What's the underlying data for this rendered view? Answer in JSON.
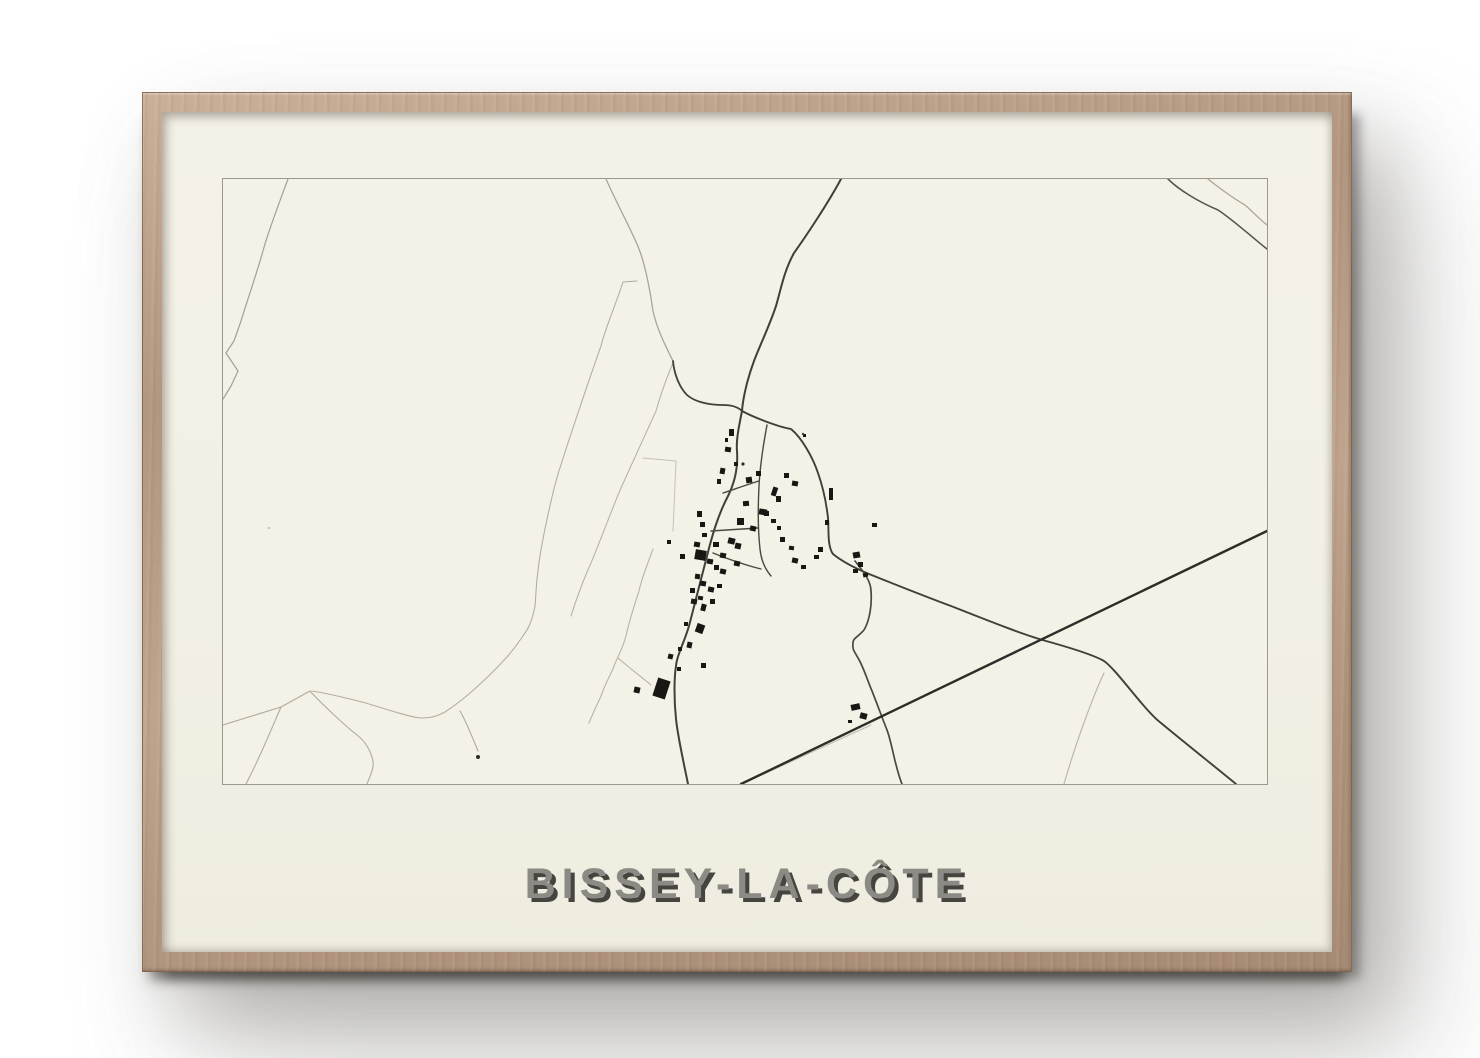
{
  "poster": {
    "title": "BISSEY-LA-CÔTE"
  },
  "palette": {
    "page_background": "#ffffff",
    "frame_wood": "#b89c84",
    "frame_wood_highlight": "#cab097",
    "frame_wood_dark": "#a68a72",
    "mat_cream": "#f2efe4",
    "map_background": "#f4f1e6",
    "map_border": "#9b988c",
    "road_dark": "#413f39",
    "road_darkest": "#2e2d29",
    "road_light": "#b7b4a7",
    "building": "#181713",
    "title_color": "#8b8a84",
    "title_shadow": "#45443f"
  },
  "map": {
    "width": 1044,
    "height": 605,
    "roads": [
      {
        "name": "field-line-top-left",
        "d": "M65 0 C56 24 44 56 40 72 C32 100 22 128 18 142 L11 162 L3 174 L15 192 L8 207 L0 220",
        "color": "#a3a196",
        "width": 1.2
      },
      {
        "name": "field-curve-north",
        "d": "M383 0 C394 25 409 52 416 70 C423 88 428 117 430 132 C434 150 442 166 450 182",
        "color": "#a8a59a",
        "width": 1.3
      },
      {
        "name": "field-band-west-a",
        "d": "M414 102 L400 103 C393 125 382 150 378 167 C369 192 344 266 336 292 C329 314 317 370 315 392 C313 405 313 417 312 427 C310 438 307 447 302 454 C295 464 290 472 282 480 C273 490 248 516 222 533 C215 537 207 539 200 539 C191 540 157 528 149 526 C141 523 103 514 89 512",
        "color": "#b2afa2",
        "width": 1.1
      },
      {
        "name": "field-band-west-b",
        "d": "M450 184 C443 200 437 218 433 232 C424 252 406 291 398 309 C389 330 374 370 368 384 C361 399 352 424 348 437",
        "color": "#b7b4a7",
        "width": 1.1
      },
      {
        "name": "field-line-south-village",
        "d": "M430 370 C425 384 419 398 416 412 C411 427 406 443 403 457 C399 472 393 480 390 490 C385 500 381 508 378 517 C374 526 369 536 366 544",
        "color": "#b7b4a7",
        "width": 1.1
      },
      {
        "name": "field-line-south-village-branch",
        "d": "M395 479 C403 486 412 493 428 506",
        "color": "#b7b4a7",
        "width": 1.1
      },
      {
        "name": "parcel-outline-west",
        "d": "M420 279 L453 282 L450 352",
        "color": "#c4c1b4",
        "width": 1.0
      },
      {
        "name": "field-network-a",
        "d": "M87 512 L58 528 L0 546",
        "color": "#aeab9e",
        "width": 1.1
      },
      {
        "name": "field-network-b",
        "d": "M58 528 C50 546 40 572 23 605",
        "color": "#aeab9e",
        "width": 1.1
      },
      {
        "name": "field-network-c",
        "d": "M87 512 C96 522 121 546 134 556 C142 562 148 572 150 582 C151 590 147 597 144 605",
        "color": "#aeab9e",
        "width": 1.1
      },
      {
        "name": "farm-spur",
        "d": "M237 532 C243 542 250 560 255 572",
        "color": "#aeab9e",
        "width": 1.1
      },
      {
        "name": "old-track-parallel",
        "d": "M519 605 L648 546",
        "color": "#c0bdb0",
        "width": 1.1
      },
      {
        "name": "branch-southeast",
        "d": "M881 494 C871 515 853 563 841 605",
        "color": "#b7b4a7",
        "width": 1.1
      },
      {
        "name": "road-topright-light",
        "d": "M985 0 C996 9 1013 21 1022 26 C1028 31 1034 38 1044 46",
        "color": "#a9a699",
        "width": 1.3
      },
      {
        "name": "road-topright-dark",
        "d": "M945 0 C956 11 976 23 995 31 C1009 40 1030 59 1044 70",
        "color": "#56544d",
        "width": 1.6
      },
      {
        "name": "road-north",
        "d": "M618 0 C604 26 581 60 571 74 C561 92 558 110 553 127 C546 148 537 166 531 182 C525 198 520 218 519 232",
        "color": "#413f39",
        "width": 2
      },
      {
        "name": "road-northwest-link",
        "d": "M450 182 C451 194 456 208 464 216 C473 224 489 226 500 226 C509 226 515 228 519 232",
        "color": "#413f39",
        "width": 1.8
      },
      {
        "name": "main-street",
        "d": "M519 232 C516 247 513 261 514 272 C515 286 513 301 505 317 C495 336 489 357 484 377 C479 396 472 424 466 447 C461 464 454 476 453 487 C451 499 451 521 453 540 C455 559 461 585 465 605",
        "color": "#413f39",
        "width": 2
      },
      {
        "name": "road-east-loop",
        "d": "M519 232 C532 239 556 248 568 250 C579 259 590 279 595 294 C601 311 604 330 605 339 C606 349 604 367 610 375 C621 384 634 390 646 395 C666 403 701 417 728 427 C761 440 801 456 823 462 C841 467 869 475 881 482 C894 491 921 531 938 544 C956 559 996 591 1013 605",
        "color": "#413f39",
        "width": 1.9
      },
      {
        "name": "road-south-curve",
        "d": "M632 382 C640 392 648 402 648 412 C649 425 647 441 641 451 C634 459 630 459 630 464 C629 471 632 473 635 479 C640 487 644 500 649 512 C653 522 660 541 664 551 C669 564 672 588 679 605",
        "color": "#4a4841",
        "width": 1.7
      },
      {
        "name": "straight-diagonal-road",
        "d": "M518 605 L1044 352",
        "color": "#2e2d29",
        "width": 2.4
      },
      {
        "name": "village-lane-vertical",
        "d": "M544 246 C541 262 537 287 536 307 C535 327 535 352 537 370 C538 380 542 390 548 397",
        "color": "#4a4841",
        "width": 1.4
      },
      {
        "name": "village-lane-upper",
        "d": "M500 314 C512 310 526 305 536 302",
        "color": "#4a4841",
        "width": 1.4
      },
      {
        "name": "village-lane-mid",
        "d": "M488 352 L535 349",
        "color": "#4a4841",
        "width": 1.4
      },
      {
        "name": "village-lane-lower",
        "d": "M490 374 C505 380 522 386 538 390",
        "color": "#4a4841",
        "width": 1.4
      }
    ],
    "buildings": [
      [
        506,
        250,
        5,
        7,
        0
      ],
      [
        502,
        268,
        6,
        5,
        8
      ],
      [
        511,
        283,
        4,
        4,
        0
      ],
      [
        497,
        289,
        5,
        6,
        10
      ],
      [
        494,
        300,
        4,
        5,
        0
      ],
      [
        523,
        298,
        6,
        6,
        -8
      ],
      [
        533,
        292,
        5,
        5,
        0
      ],
      [
        549,
        308,
        5,
        9,
        18
      ],
      [
        520,
        322,
        6,
        5,
        -5
      ],
      [
        536,
        330,
        8,
        6,
        10
      ],
      [
        514,
        339,
        7,
        7,
        0
      ],
      [
        527,
        347,
        6,
        5,
        12
      ],
      [
        505,
        359,
        7,
        6,
        14
      ],
      [
        474,
        332,
        5,
        6,
        0
      ],
      [
        477,
        343,
        5,
        5,
        0
      ],
      [
        479,
        354,
        5,
        4,
        0
      ],
      [
        471,
        363,
        6,
        5,
        10
      ],
      [
        490,
        363,
        6,
        5,
        0
      ],
      [
        512,
        364,
        6,
        6,
        12
      ],
      [
        497,
        374,
        6,
        5,
        10
      ],
      [
        511,
        382,
        6,
        5,
        12
      ],
      [
        472,
        371,
        11,
        10,
        10
      ],
      [
        484,
        380,
        6,
        5,
        10
      ],
      [
        491,
        386,
        5,
        5,
        0
      ],
      [
        497,
        390,
        6,
        5,
        12
      ],
      [
        472,
        395,
        5,
        5,
        8
      ],
      [
        477,
        402,
        6,
        5,
        10
      ],
      [
        485,
        408,
        6,
        5,
        12
      ],
      [
        467,
        409,
        5,
        5,
        0
      ],
      [
        475,
        417,
        5,
        4,
        10
      ],
      [
        494,
        405,
        5,
        4,
        0
      ],
      [
        606,
        309,
        4,
        12,
        0
      ],
      [
        595,
        368,
        5,
        5,
        0
      ],
      [
        630,
        373,
        7,
        6,
        -10
      ],
      [
        635,
        383,
        5,
        5,
        0
      ],
      [
        630,
        390,
        5,
        4,
        0
      ],
      [
        640,
        394,
        5,
        4,
        -12
      ],
      [
        591,
        376,
        5,
        4,
        0
      ],
      [
        569,
        379,
        6,
        5,
        12
      ],
      [
        578,
        386,
        5,
        4,
        0
      ],
      [
        557,
        358,
        5,
        5,
        0
      ],
      [
        566,
        367,
        5,
        4,
        8
      ],
      [
        602,
        341,
        4,
        5,
        0
      ],
      [
        468,
        420,
        6,
        5,
        10
      ],
      [
        478,
        425,
        5,
        7,
        14
      ],
      [
        487,
        420,
        5,
        5,
        0
      ],
      [
        461,
        443,
        4,
        4,
        0
      ],
      [
        473,
        445,
        8,
        9,
        20
      ],
      [
        464,
        463,
        5,
        6,
        12
      ],
      [
        455,
        468,
        4,
        4,
        0
      ],
      [
        445,
        475,
        5,
        5,
        14
      ],
      [
        454,
        488,
        4,
        4,
        0
      ],
      [
        478,
        484,
        5,
        5,
        0
      ],
      [
        411,
        508,
        6,
        6,
        12
      ],
      [
        432,
        500,
        13,
        19,
        18
      ],
      [
        649,
        344,
        5,
        4,
        0
      ],
      [
        628,
        525,
        9,
        6,
        -12
      ],
      [
        637,
        534,
        7,
        6,
        15
      ],
      [
        625,
        541,
        4,
        3,
        0
      ],
      [
        580,
        255,
        3,
        3,
        0
      ],
      [
        502,
        259,
        3,
        4,
        0
      ],
      [
        561,
        294,
        5,
        5,
        0
      ],
      [
        569,
        302,
        6,
        5,
        10
      ],
      [
        553,
        317,
        5,
        6,
        0
      ],
      [
        541,
        332,
        5,
        5,
        0
      ],
      [
        548,
        340,
        5,
        4,
        0
      ],
      [
        554,
        347,
        4,
        4,
        0
      ],
      [
        457,
        375,
        5,
        5,
        0
      ],
      [
        444,
        361,
        4,
        4,
        0
      ]
    ],
    "dots": [
      {
        "x": 520,
        "y": 285,
        "r": 1.6,
        "color": "#2e2d29"
      },
      {
        "x": 255,
        "y": 578,
        "r": 2.0,
        "color": "#2e2d29"
      },
      {
        "x": 580,
        "y": 255,
        "r": 1.2,
        "color": "#45443f"
      },
      {
        "x": 46,
        "y": 349,
        "r": 1.0,
        "color": "#b7b4a7"
      }
    ]
  }
}
